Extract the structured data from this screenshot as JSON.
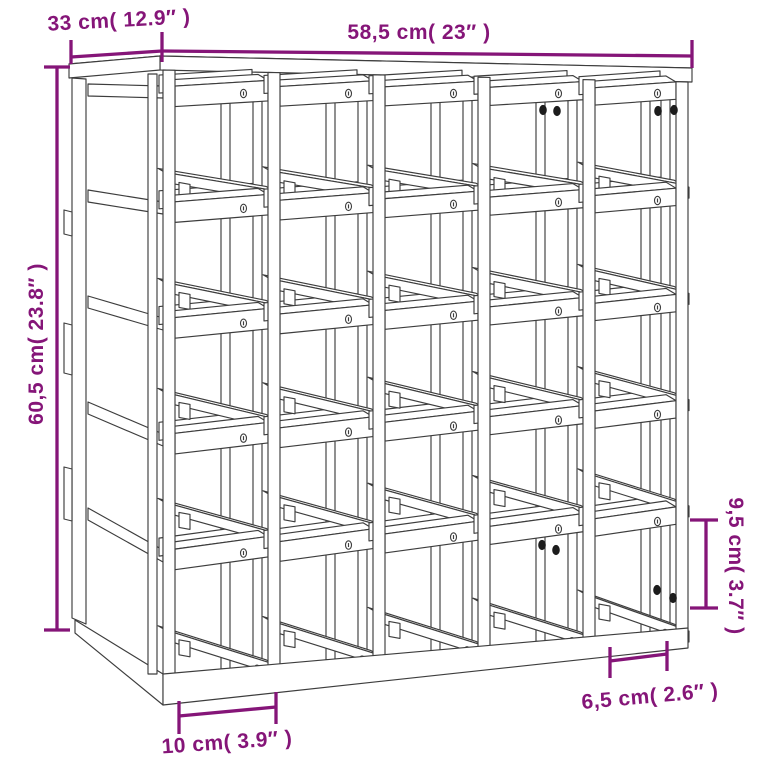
{
  "diagram": {
    "subject": "wine-rack-dimension-drawing",
    "background_color": "#ffffff",
    "accent_color": "#851578",
    "ink_color": "#3d3d3d",
    "screw_color": "#1c1c1c",
    "grid": {
      "rows": 5,
      "columns": 5
    },
    "dimensions": {
      "depth": {
        "label": "33 cm( 12.9″ )",
        "value_cm": 33,
        "value_in": 12.9
      },
      "width": {
        "label": "58,5 cm( 23″ )",
        "value_cm": 58.5,
        "value_in": 23
      },
      "height": {
        "label": "60,5 cm( 23.8″ )",
        "value_cm": 60.5,
        "value_in": 23.8
      },
      "slot_height": {
        "label": "9,5 cm( 3.7″ )",
        "value_cm": 9.5,
        "value_in": 3.7
      },
      "foot_offset": {
        "label": "6,5 cm( 2.6″ )",
        "value_cm": 6.5,
        "value_in": 2.6
      },
      "slot_width": {
        "label": "10 cm( 3.9″ )",
        "value_cm": 10,
        "value_in": 3.9
      }
    }
  }
}
